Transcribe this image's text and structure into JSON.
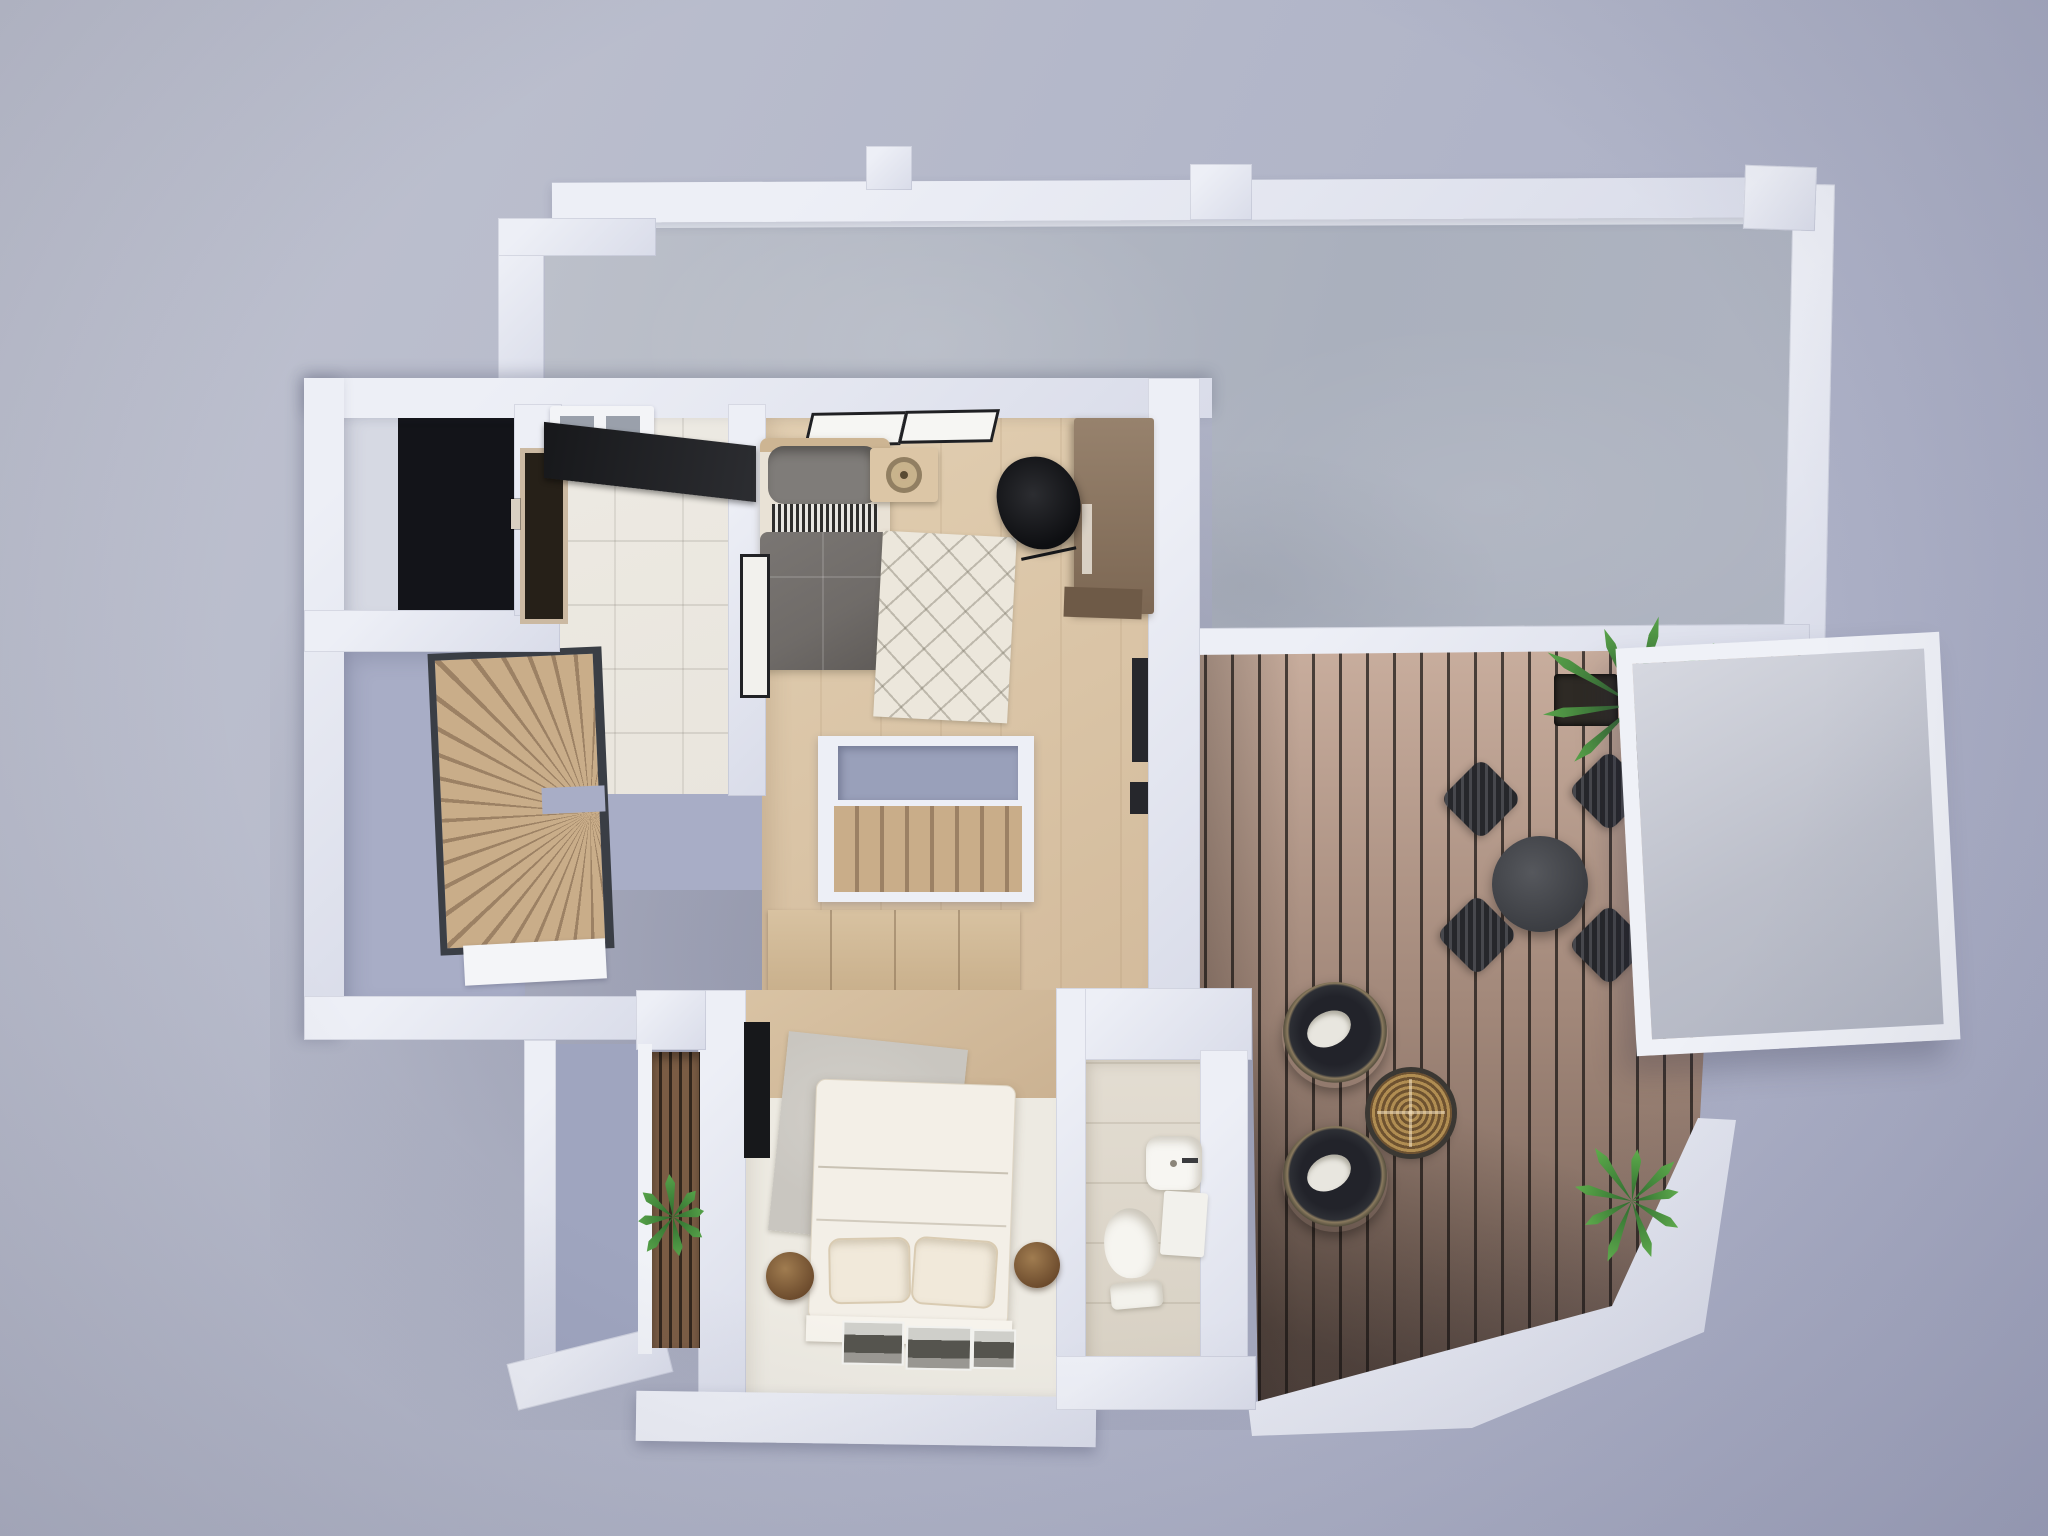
{
  "scene": {
    "title": "Top-down 3D render of an upper-floor apartment plan with roof terrace",
    "view": "top-down-3d-render",
    "visible_text": []
  },
  "palette": {
    "bg-1": "#c0c3d0",
    "bg-2": "#a6aac3",
    "wall": "#edeff6",
    "wall-shade": "#d9dce9",
    "concrete-1": "#bcc0ca",
    "concrete-2": "#aab0bd",
    "deck-light": "#c9ae9e",
    "deck-mid": "#a18779",
    "deck-dark": "#6d5a51",
    "wood-floor-1": "#e2cfb2",
    "wood-floor-2": "#d3bb9c",
    "wood-stair-1": "#c9ad89",
    "wood-stair-2": "#9c8164",
    "tile-floor": "#e9e5dd",
    "lavender-floor": "#a8adc6",
    "lavender-void": "#99a0ba",
    "black-void": "#131419",
    "bed-duvet": "#6f6b68",
    "bed-pillow": "#7f7c79",
    "bed-white": "#f3efe7",
    "rug-cream": "#ece7dc",
    "rug-gray": "#c9c6c0",
    "plant-dark": "#2d5c2e",
    "plant-light": "#58a34a"
  },
  "areas": [
    {
      "name": "roof-concrete-terrace",
      "objects": [
        "parapet-walls",
        "glass-balustrade"
      ]
    },
    {
      "name": "wood-deck-terrace",
      "objects": [
        "round-dining-table",
        "dining-chairs",
        "palm-plant",
        "lounge-chairs",
        "wicker-side-table",
        "fern-plant",
        "skylight-panel",
        "white-platform"
      ]
    },
    {
      "name": "guest-bedroom",
      "objects": [
        "single-bed-gray",
        "nightstand-with-tray",
        "wall-picture-frames",
        "desk-wardrobe",
        "black-desk-chair",
        "diamond-pattern-rug",
        "leaning-picture-frame"
      ]
    },
    {
      "name": "hallway-stairwell",
      "objects": [
        "straight-wood-staircase",
        "stairwell-void",
        "wood-floor"
      ]
    },
    {
      "name": "utility-kitchenette",
      "objects": [
        "black-counter",
        "white-appliance",
        "tile-floor",
        "lift-door-with-panel"
      ]
    },
    {
      "name": "stair-room",
      "objects": [
        "winder-staircase",
        "white-doormat"
      ]
    },
    {
      "name": "storage-void-room",
      "objects": [
        "black-floor-opening"
      ]
    },
    {
      "name": "master-bedroom",
      "objects": [
        "double-bed-white",
        "two-pillows",
        "round-wood-side-tables",
        "tv-panel",
        "gray-textured-rug",
        "wardrobe-top",
        "photo-prints-on-floor",
        "slat-window",
        "window-plant",
        "balcony-strip"
      ]
    },
    {
      "name": "bathroom",
      "objects": [
        "wall-hung-sink",
        "toilet",
        "shelf"
      ]
    }
  ]
}
